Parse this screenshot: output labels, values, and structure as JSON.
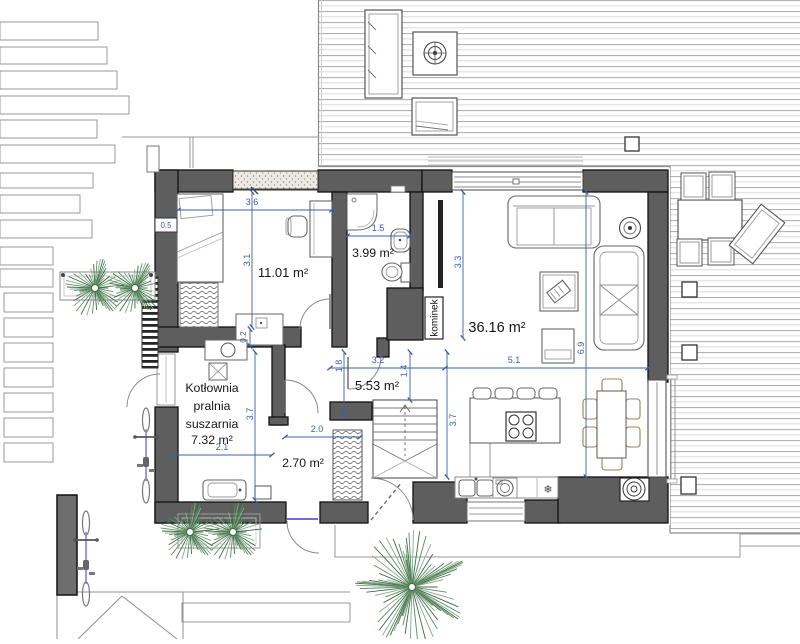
{
  "colors": {
    "wall": "#5e5e5e",
    "dimension_blue": "#3a5fa8",
    "threshold_blue": "#3344cc",
    "plant_green": "#3c6b43",
    "bike_accent": "#8a7fd4",
    "chair_tan": "#a08055"
  },
  "rooms": {
    "bedroom": {
      "area": "11.01 m²"
    },
    "bathroom": {
      "area": "3.99 m²"
    },
    "living": {
      "area": "36.16 m²"
    },
    "hall": {
      "area": "5.53 m²"
    },
    "vestibule": {
      "area": "2.70 m²"
    },
    "utility": {
      "lines": [
        "Kotłownia",
        "pralnia",
        "suszarnia",
        "7.32 m²"
      ]
    },
    "fireplace_label": "kominek"
  },
  "dimensions": {
    "bedroom_offset": "0.5",
    "bedroom_width": "3.6",
    "bedroom_depth": "3.1",
    "bathroom_width": "1.5",
    "living_left_depth": "3.3",
    "living_width": "5.1",
    "living_depth": "6.9",
    "hall_width": "3.2",
    "hall_seg_a": "1.8",
    "hall_seg_b": "1.4",
    "hall_depth": "3.7",
    "utility_width": "2.1",
    "utility_depth": "3.7",
    "vestibule_width": "2.0",
    "wall_thickness": "0.2"
  },
  "symbols": {
    "fridge": "❄"
  }
}
